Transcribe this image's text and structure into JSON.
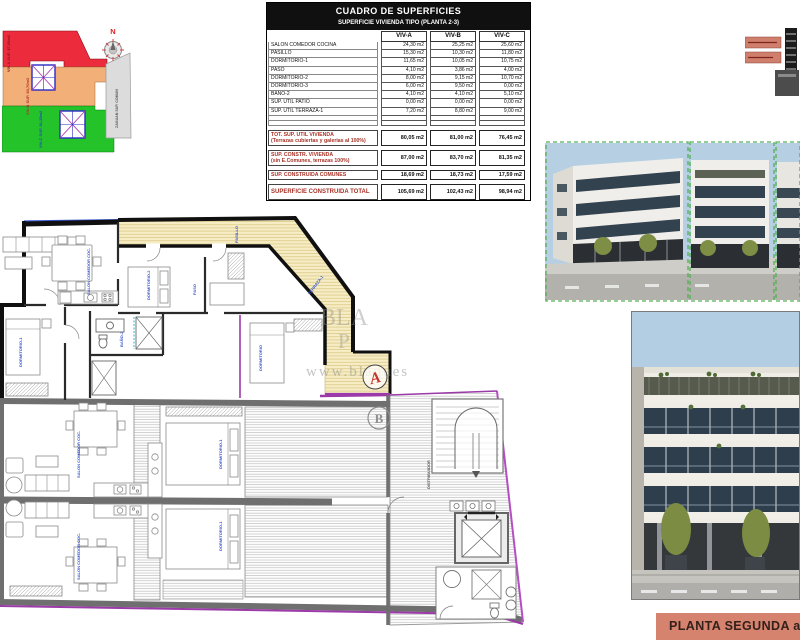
{
  "site_plan": {
    "north_label": "N",
    "labels": {
      "viv_a": "VIV-A SUP. 87,00m2",
      "viv_b": "VIV-B SUP. 83,70m2",
      "viv_c": "VIV-C SUP. 81,35m2",
      "zaguan": "ZAGUAN SUP. COMUN"
    },
    "colors": {
      "viv_a": "#ec2c3c",
      "viv_b": "#f2b078",
      "viv_c": "#24c32a",
      "zaguan": "#dcdcdc"
    }
  },
  "areas_table": {
    "title": "CUADRO DE SUPERFICIES",
    "subtitle": "SUPERFICIE VIVIENDA TIPO  (PLANTA 2-3)",
    "columns": [
      "VIV-A",
      "VIV-B",
      "VIV-C"
    ],
    "rows": [
      {
        "label": "SALON COMEDOR COCINA",
        "values": [
          "24,30 m2",
          "25,25 m2",
          "25,60 m2"
        ]
      },
      {
        "label": "PASILLO",
        "values": [
          "15,30 m2",
          "10,30 m2",
          "11,80 m2"
        ]
      },
      {
        "label": "DORMITORIO-1",
        "values": [
          "11,65 m2",
          "10,05 m2",
          "10,75 m2"
        ]
      },
      {
        "label": "PASO",
        "values": [
          "4,10 m2",
          "3,86 m2",
          "4,00 m2"
        ]
      },
      {
        "label": "DORMITORIO-2",
        "values": [
          "8,00 m2",
          "9,15 m2",
          "10,70 m2"
        ]
      },
      {
        "label": "DORMITORIO-3",
        "values": [
          "6,00 m2",
          "9,50 m2",
          "0,00 m2"
        ]
      },
      {
        "label": "BAÑO-2",
        "values": [
          "4,10 m2",
          "4,10 m2",
          "5,10 m2"
        ]
      },
      {
        "label": "SUP. ÚTIL PATIO",
        "values": [
          "0,00 m2",
          "0,00 m2",
          "0,00 m2"
        ]
      },
      {
        "label": "SUP. ÚTIL TERRAZA-1",
        "values": [
          "7,20 m2",
          "8,80 m2",
          "9,00 m2"
        ]
      }
    ],
    "totals": [
      {
        "label": "TOT. SUP. UTIL VIVIENDA",
        "sublabel": "(Terrazas cubiertas y galerias al 100%)",
        "values": [
          "80,05 m2",
          "81,00 m2",
          "76,45 m2"
        ]
      },
      {
        "label": "SUP. CONSTR. VIVIENDA",
        "sublabel": "(sin E.Comunes, terrazas 100%)",
        "values": [
          "87,00 m2",
          "83,70 m2",
          "81,35 m2"
        ]
      },
      {
        "label": "SUP. CONSTRUIDA COMUNES",
        "sublabel": "",
        "values": [
          "18,69 m2",
          "18,73 m2",
          "17,59 m2"
        ]
      },
      {
        "label": "SUPERFICIE CONSTRUIDA TOTAL",
        "sublabel": "",
        "values": [
          "105,69 m2",
          "102,43 m2",
          "98,94 m2"
        ]
      }
    ]
  },
  "floor_plan": {
    "unit_a": "A",
    "unit_b": "B",
    "room_labels": {
      "salon_a": "SALON COMEDOR COC.",
      "dorm_a1": "DORMITORIO-1",
      "dorm_2": "DORMITORIO-2",
      "paso": "PASO",
      "pasillo": "PASILLO",
      "dorm_b": "DORMITORIO",
      "bano": "BAÑO-2",
      "terraza": "TERRAZA-1",
      "salon_low": "SALON COMEDOR COC.",
      "dorm_low": "DORMITORIO-1",
      "distribuidor": "DISTRIBUIDOR"
    },
    "watermark": {
      "big": "BLA",
      "mid": "P",
      "url": "www.blaques"
    }
  },
  "footer": {
    "label": "PLANTA SEGUNDA a"
  }
}
